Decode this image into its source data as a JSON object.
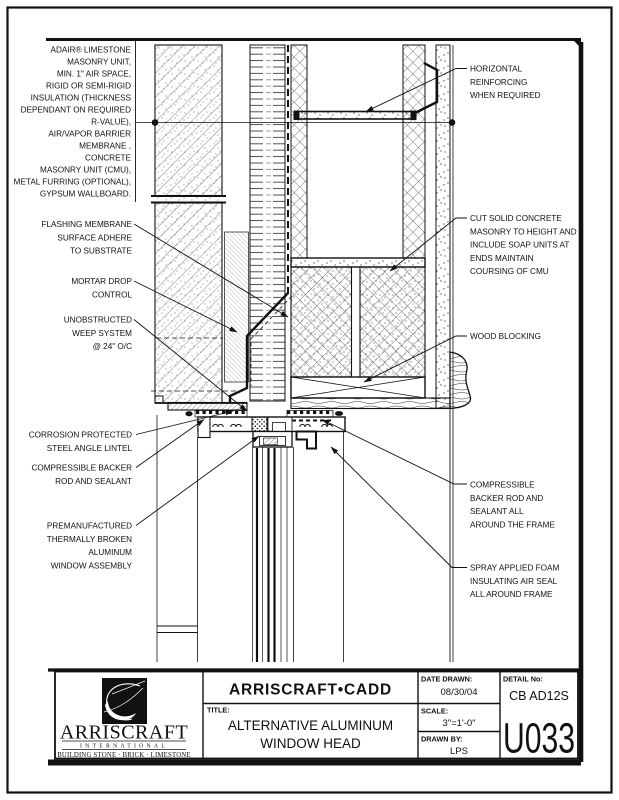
{
  "sheet": {
    "note_adair": {
      "lines": [
        "ADAIR® LIMESTONE",
        "MASONRY UNIT,",
        "MIN. 1\" AIR SPACE,",
        "RIGID OR SEMI-RIGID",
        "INSULATION (THICKNESS",
        "DEPENDANT ON REQUIRED",
        "R-VALUE),",
        "AIR/VAPOR BARRIER",
        "MEMBRANE ,",
        "CONCRETE",
        "MASONRY UNIT (CMU),",
        "METAL FURRING (OPTIONAL),",
        "GYPSUM WALLBOARD."
      ]
    },
    "labels_left": [
      {
        "id": "flashing",
        "lines": [
          "FLASHING MEMBRANE",
          "SURFACE ADHERE",
          "TO SUBSTRATE"
        ]
      },
      {
        "id": "mortar",
        "lines": [
          "MORTAR DROP",
          "CONTROL"
        ]
      },
      {
        "id": "weep",
        "lines": [
          "UNOBSTRUCTED",
          "WEEP SYSTEM",
          "@ 24\" O/C"
        ]
      },
      {
        "id": "lintel",
        "lines": [
          "CORROSION PROTECTED",
          "STEEL ANGLE LINTEL"
        ]
      },
      {
        "id": "backer",
        "lines": [
          "COMPRESSIBLE BACKER",
          "ROD AND SEALANT"
        ]
      },
      {
        "id": "window",
        "lines": [
          "PREMANUFACTURED",
          "THERMALLY BROKEN",
          "ALUMINUM",
          "WINDOW ASSEMBLY"
        ]
      }
    ],
    "labels_right": [
      {
        "id": "reinforcing",
        "lines": [
          "HORIZONTAL",
          "REINFORCING",
          "WHEN REQUIRED"
        ]
      },
      {
        "id": "cut_masonry",
        "lines": [
          "CUT SOLID CONCRETE",
          "MASONRY TO HEIGHT AND",
          "INCLUDE SOAP UNITS AT",
          "ENDS MAINTAIN",
          "COURSING OF CMU"
        ]
      },
      {
        "id": "wood_blocking",
        "lines": [
          "WOOD BLOCKING"
        ]
      },
      {
        "id": "backer_frame",
        "lines": [
          "COMPRESSIBLE",
          "BACKER ROD AND",
          "SEALANT ALL",
          "AROUND THE FRAME"
        ]
      },
      {
        "id": "spray_foam",
        "lines": [
          "SPRAY APPLIED FOAM",
          "INSULATING AIR SEAL",
          "ALL AROUND FRAME"
        ]
      }
    ]
  },
  "title_block": {
    "cadd_header": "ARRISCRAFT•CADD",
    "title_label": "TITLE:",
    "title_line1": "ALTERNATIVE ALUMINUM",
    "title_line2": "WINDOW HEAD",
    "date_drawn_label": "DATE DRAWN:",
    "date_drawn": "08/30/04",
    "scale_label": "SCALE:",
    "scale": "3\"=1'-0\"",
    "drawn_by_label": "DRAWN BY:",
    "drawn_by": "LPS",
    "detail_no_label": "DETAIL No:",
    "detail_code": "CB AD12S",
    "detail_number": "U033",
    "logo": {
      "name": "ARRISCRAFT",
      "subtitle": "INTERNATIONAL",
      "tagline": "BUILDING STONE · BRICK · LIMESTONE"
    }
  },
  "colors": {
    "ink": "#111111",
    "paper": "#ffffff"
  }
}
